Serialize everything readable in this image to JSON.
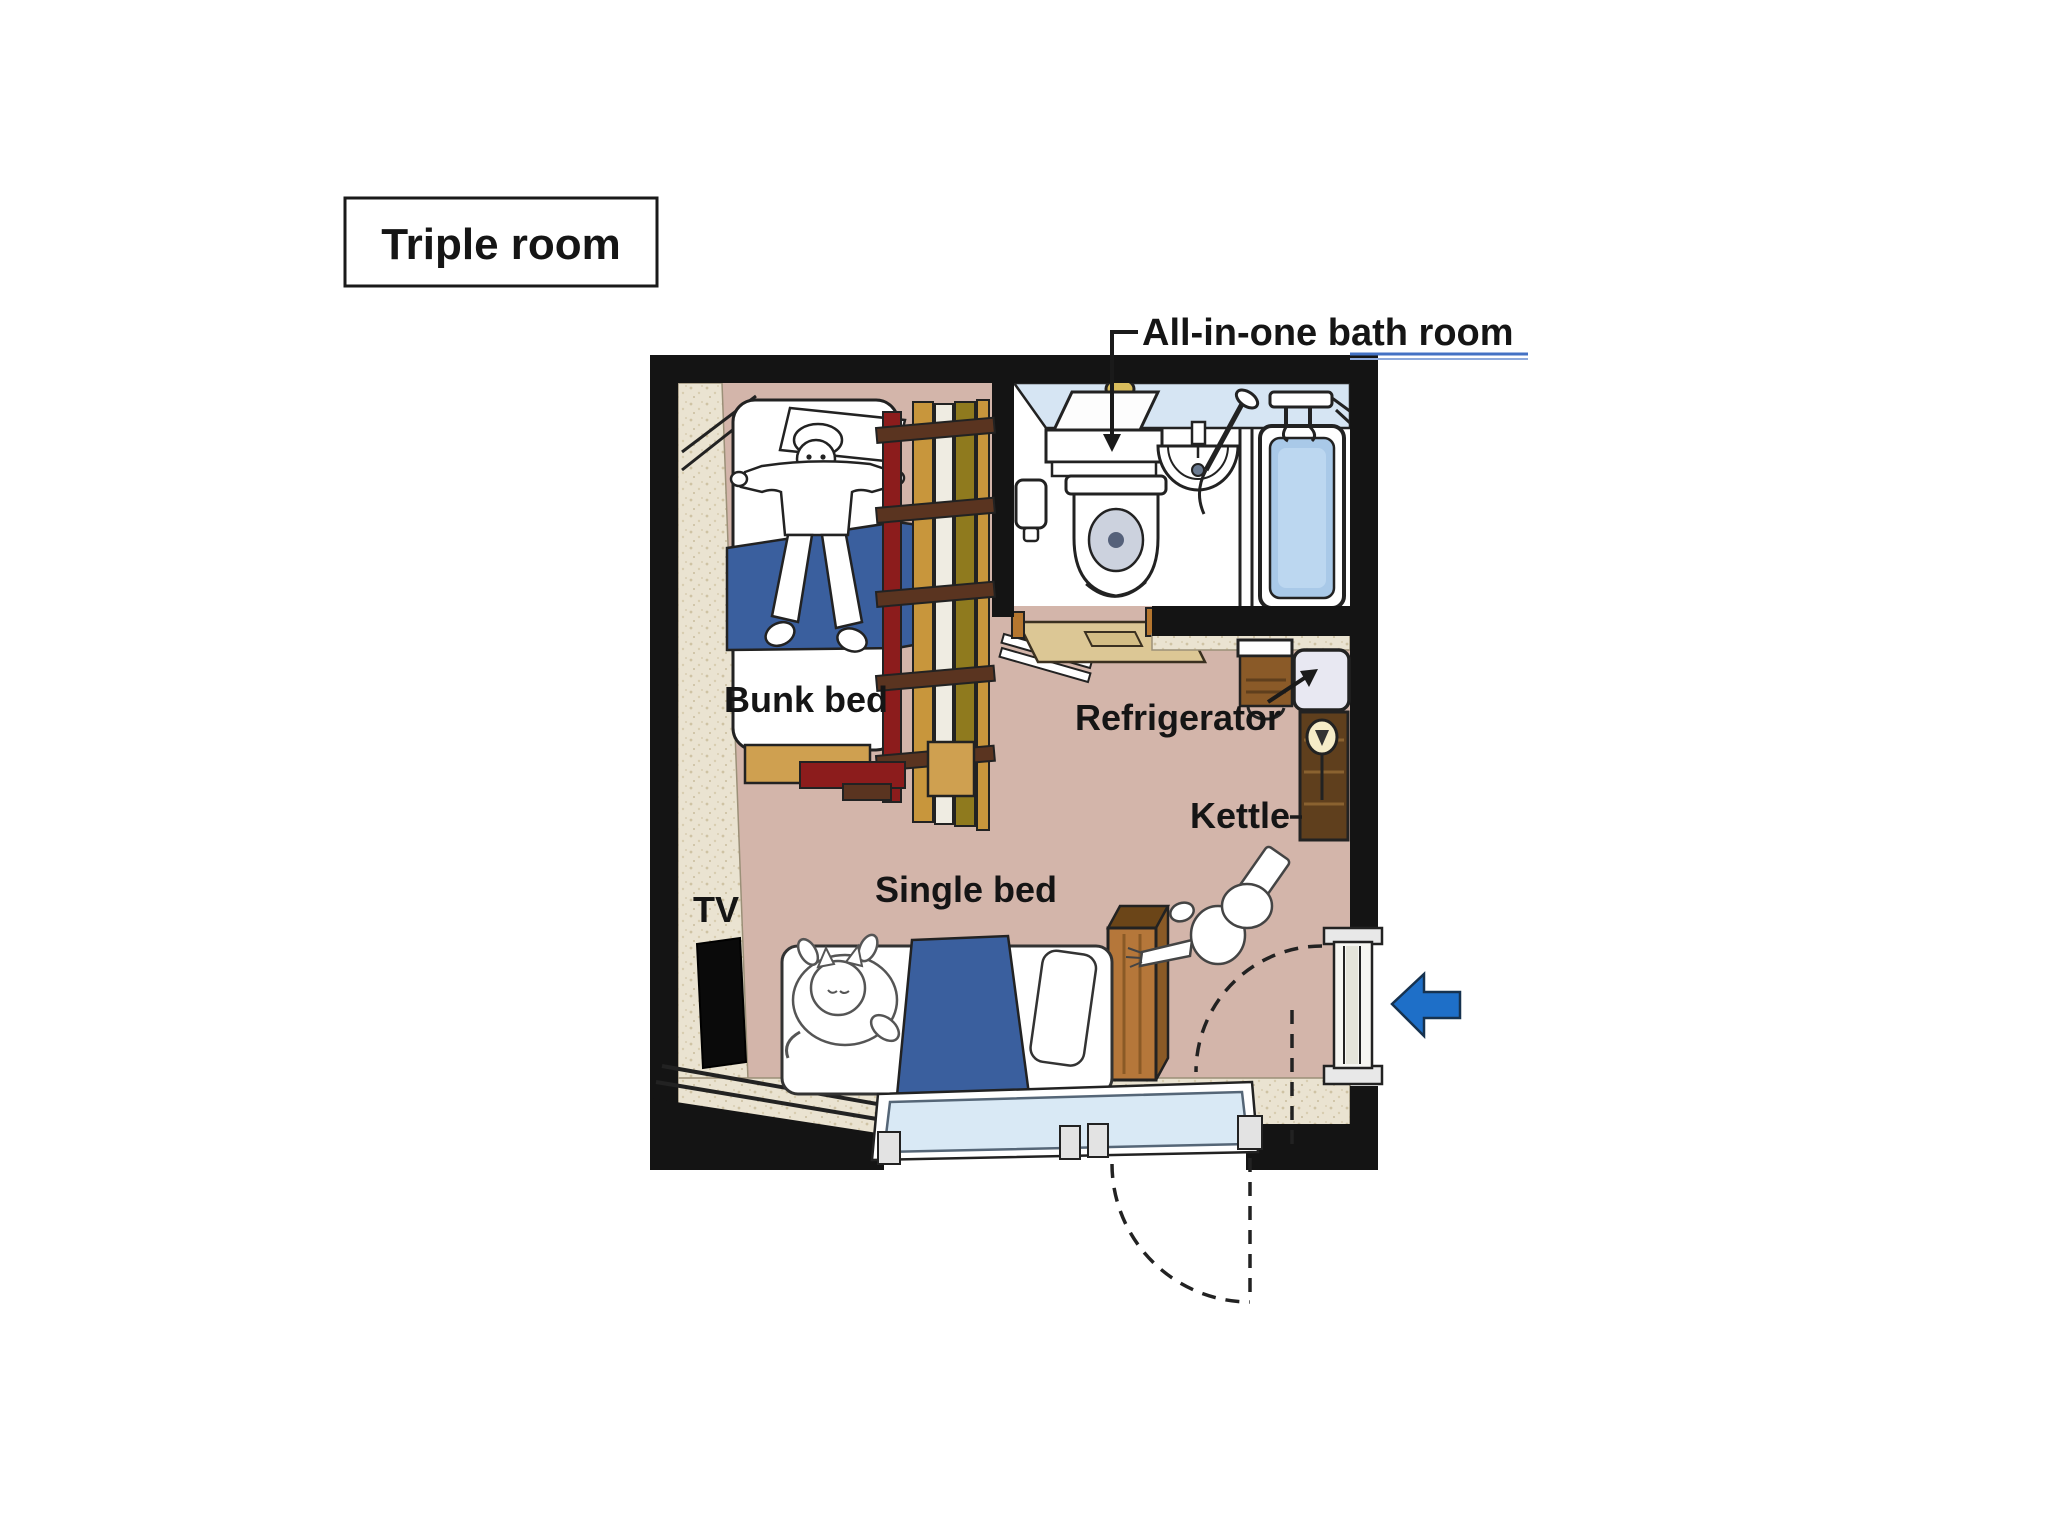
{
  "title": "Triple room",
  "labels": {
    "bathroom_prefix": "All-in-one ",
    "bathroom_underlined": "bath room",
    "bunk_bed": "Bunk bed",
    "refrigerator": "Refrigerator",
    "kettle": "Kettle",
    "single_bed": "Single bed",
    "tv": "TV"
  },
  "colors": {
    "wall": "#141414",
    "floor_main": "#d3b5aa",
    "floor_trim": "#eae3d1",
    "mat": "#dcc795",
    "bath_wall_band": "#d6e5f3",
    "tub_water": "#a9c9e8",
    "blanket": "#3a5f9e",
    "bunk_frame": "#8c1c1c",
    "wood_light": "#c8963c",
    "wood_olive": "#8f7a1e",
    "wood_dark": "#5f3f1d",
    "headboard": "#b5773a",
    "fridge": "#e8e8f2",
    "kettle": "#f5ecc8",
    "entrance_arrow": "#1e6fc8",
    "underline_blue": "#4472c4",
    "window_glass": "#d9e9f5"
  }
}
